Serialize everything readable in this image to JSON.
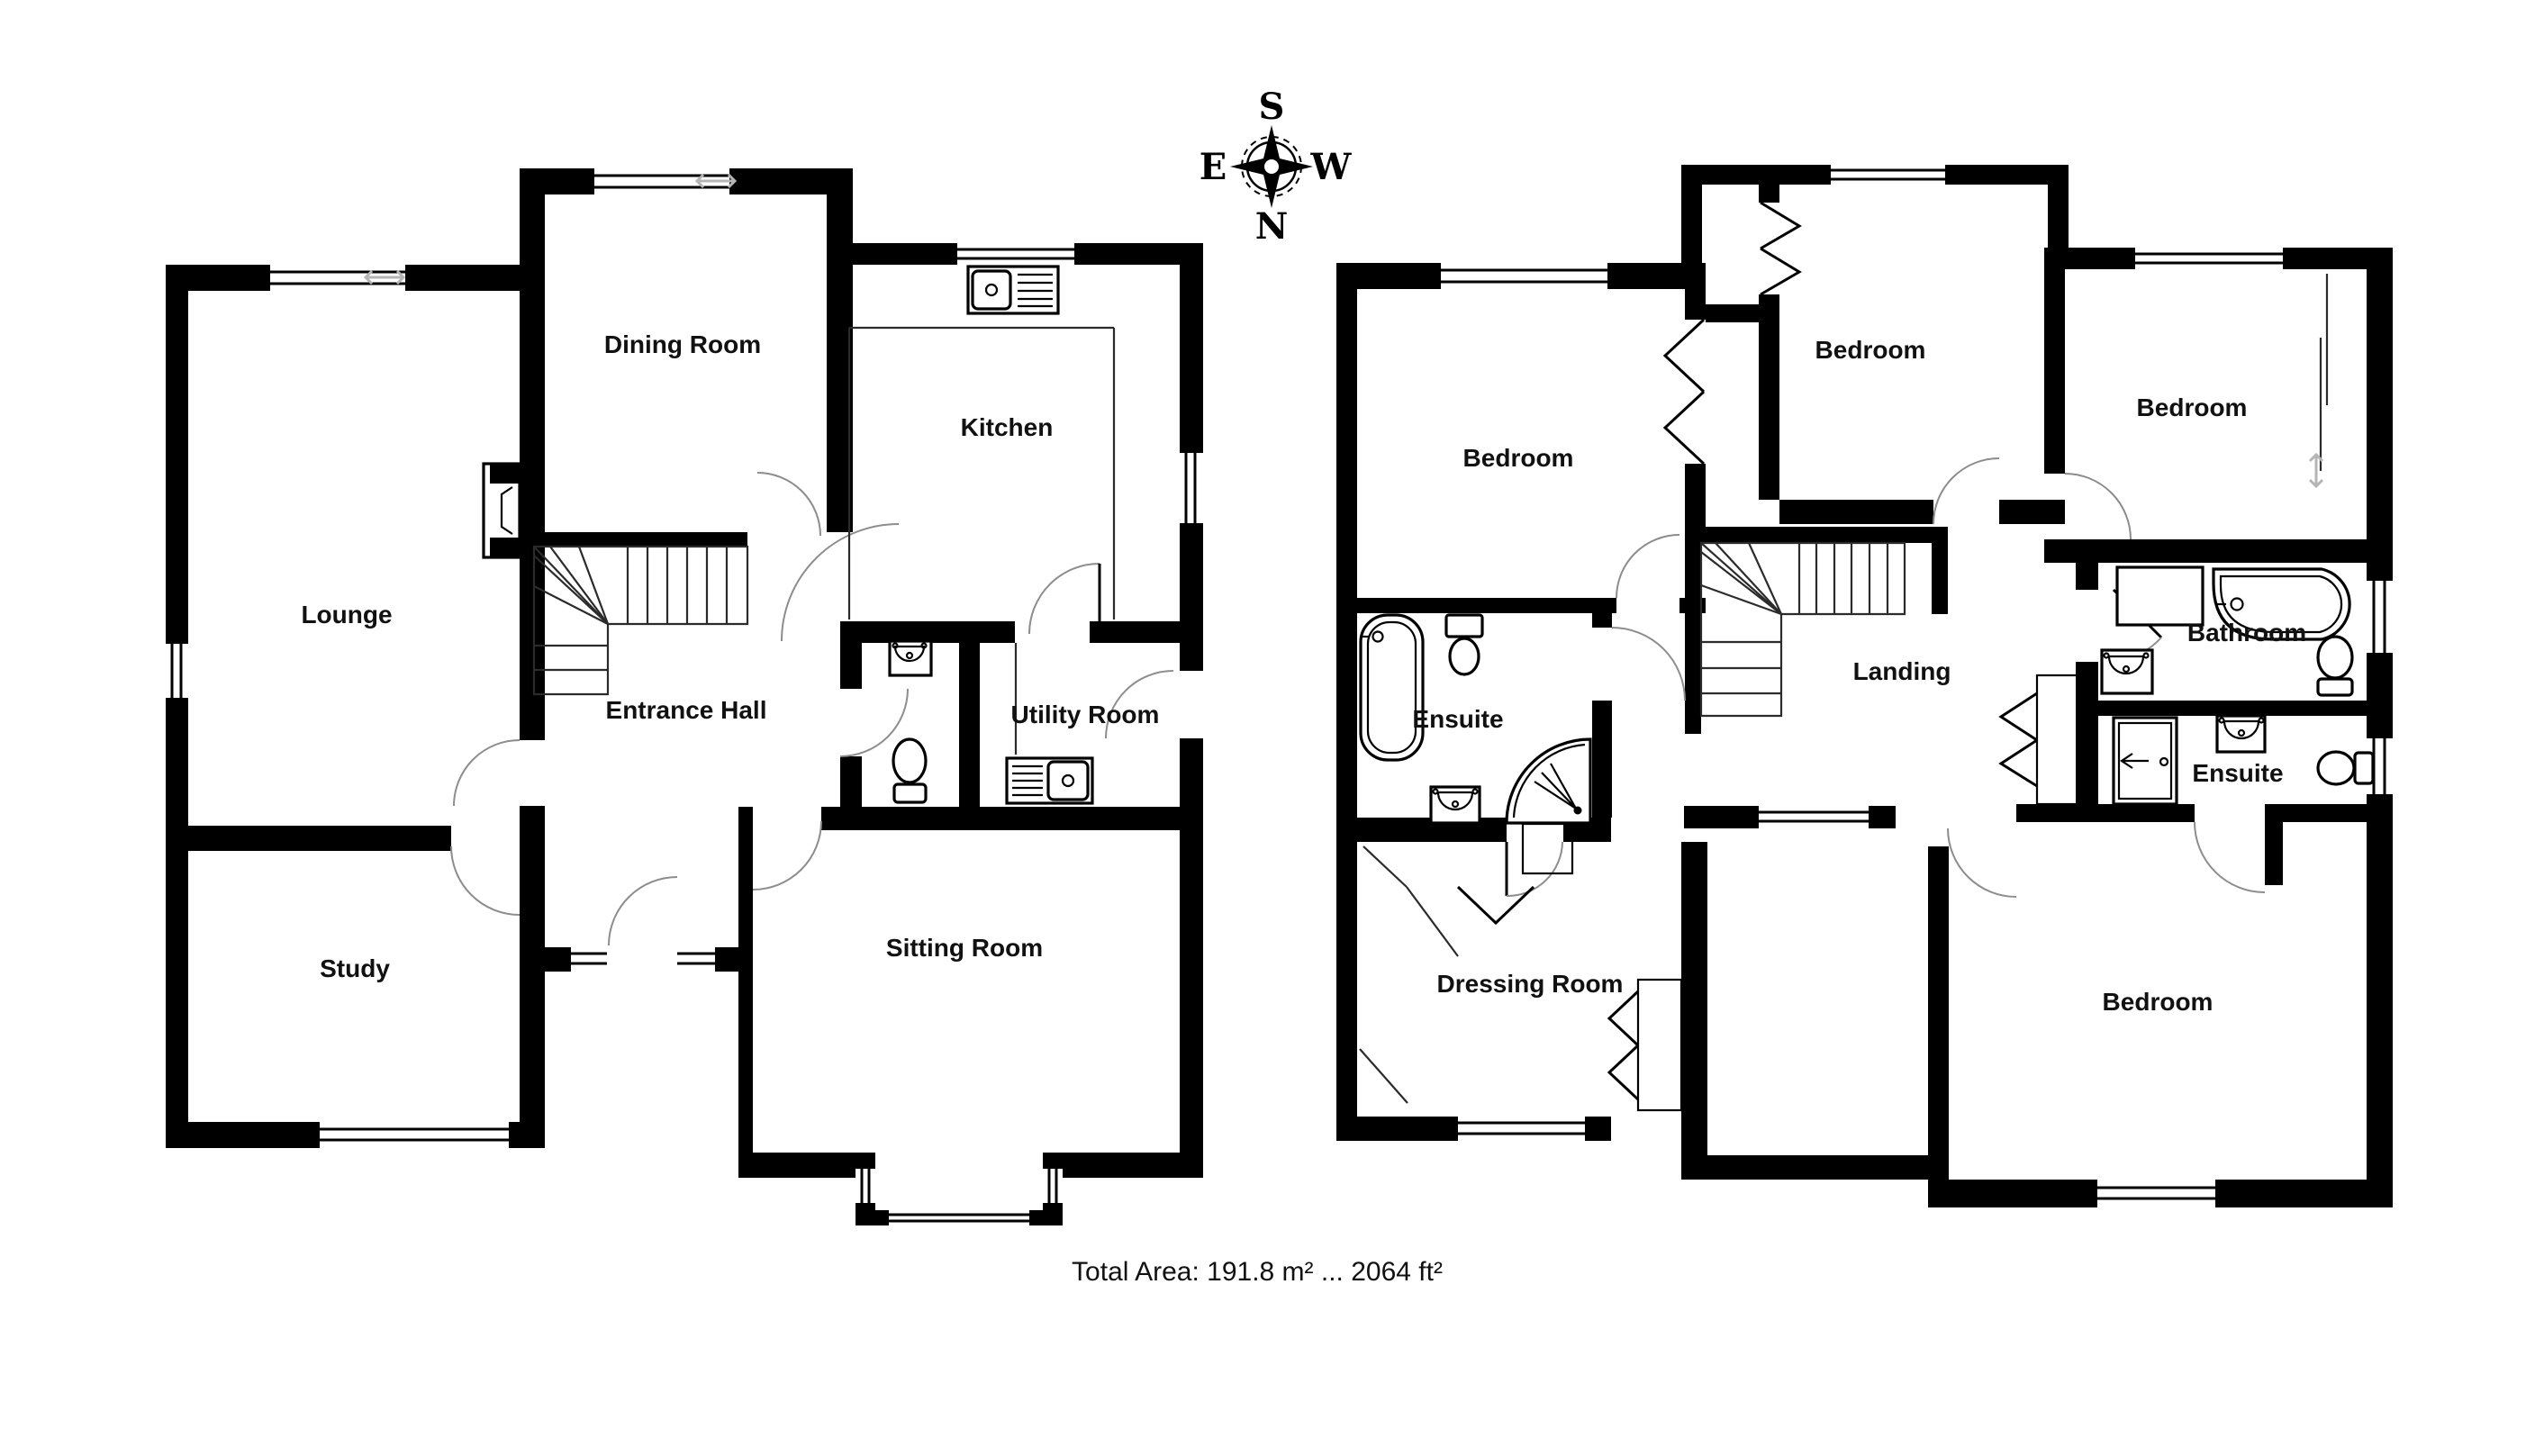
{
  "meta": {
    "title": "House floor plan",
    "total_area_label": "Total Area: 191.8 m² ... 2064 ft²"
  },
  "colors": {
    "wall": "#000000",
    "background": "#ffffff",
    "door_arc": "#8d8d8d",
    "window_arrow": "#b5b5b5",
    "text": "#111111"
  },
  "compass": {
    "top": "S",
    "bottom": "N",
    "left": "E",
    "right": "W"
  },
  "ground_floor": {
    "rooms": [
      {
        "id": "lounge",
        "label": "Lounge"
      },
      {
        "id": "dining-room",
        "label": "Dining Room"
      },
      {
        "id": "kitchen",
        "label": "Kitchen"
      },
      {
        "id": "entrance-hall",
        "label": "Entrance Hall"
      },
      {
        "id": "utility-room",
        "label": "Utility Room"
      },
      {
        "id": "study",
        "label": "Study"
      },
      {
        "id": "sitting-room",
        "label": "Sitting Room"
      }
    ]
  },
  "first_floor": {
    "rooms": [
      {
        "id": "bedroom-1",
        "label": "Bedroom"
      },
      {
        "id": "bedroom-2",
        "label": "Bedroom"
      },
      {
        "id": "bedroom-3",
        "label": "Bedroom"
      },
      {
        "id": "ensuite-1",
        "label": "Ensuite"
      },
      {
        "id": "bathroom",
        "label": "Bathroom"
      },
      {
        "id": "ensuite-2",
        "label": "Ensuite"
      },
      {
        "id": "landing",
        "label": "Landing"
      },
      {
        "id": "dressing-room",
        "label": "Dressing Room"
      },
      {
        "id": "bedroom-4",
        "label": "Bedroom"
      }
    ]
  }
}
